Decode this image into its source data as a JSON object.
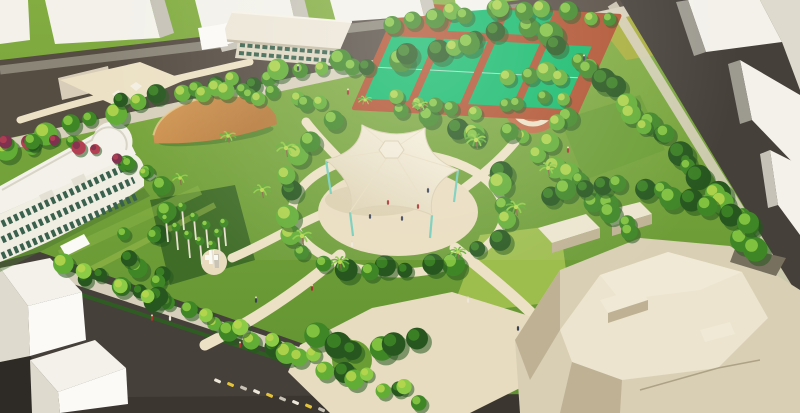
{
  "meta": {
    "title": "Aerial architectural rendering of a tropical urban park surrounded by city streets"
  },
  "palette": {
    "roadDark": "#46403a",
    "roadMid": "#554c42",
    "roadEdge": "#8a8577",
    "sidewalk": "#d7cfbb",
    "hedge": "#2f5c23",
    "path": "#ece1c4",
    "plazaCream": "#e9dcbe",
    "lawnTop": "#83ad41",
    "lawnBottom": "#5e9130",
    "lawnLight": "#9dbd4d",
    "lawnMid": "#6b9d35",
    "lawnDark": "#3f6c27",
    "lawnOlive": "#a9ae3c",
    "treeDark": "#27571f",
    "treeMid": "#3f8627",
    "treeLight": "#62ad35",
    "treeBright": "#8ccb45",
    "treeYellow": "#b9d74f",
    "flowerRed": "#b24052",
    "flowerPurple": "#7e3250",
    "bldgWhite": "#f3f1ea",
    "bldgBright": "#fbfaf6",
    "bldgFace": "#c6c2b7",
    "bldgFaceDark": "#9d9a90",
    "bldgShade": "#dedacd",
    "beigeTop": "#ece4ce",
    "beigeFace": "#d9cfb4",
    "beigeShade": "#bfb294",
    "beigeDark": "#8f8468",
    "courtGreen": "#12b96a",
    "courtRed": "#b0512f",
    "courtRedLight": "#c06a45",
    "canopyCream": "#f6f0dd",
    "canopyEdge": "#dcd0b0",
    "canopyShadow": "#cfc19e",
    "columnTeal": "#72ccba",
    "domeTan": "#d49a57",
    "domeDark": "#b6793a",
    "statueGold": "#e6bf3e",
    "trunkBrown": "#8a6b48",
    "palmWhite": "#e8e0cf",
    "windowGreen": "#3a614d",
    "shadowDark": "#2e2a26"
  },
  "scene": {
    "description": "Bird's-eye render of a park: white city blocks around the edges, dark perimeter streets, a historic white colonnaded building on the left, an activity building with a wide flat roof at top, four bright-green sport courts with terracotta surrounds, a gold statue plaza, an orange shade pavilion, a royal-palm grove, and a large cream tensile canopy over a circular central plaza; a faceted beige civic complex fills the lower right.",
    "elements": [
      {
        "name": "perimeter-roads",
        "desc": "dark asphalt streets on all four sides"
      },
      {
        "name": "city-blocks",
        "desc": "white massing models of surrounding buildings"
      },
      {
        "name": "historic-building",
        "desc": "white 3-storey building with green shuttered windows and curved corner"
      },
      {
        "name": "activity-building",
        "desc": "two-storey hall with oversized flat roof"
      },
      {
        "name": "sport-courts",
        "desc": "bright green courts with terracotta borders"
      },
      {
        "name": "statue-plaza",
        "desc": "circular plaza with golden statue"
      },
      {
        "name": "shade-pavilion",
        "desc": "long tan fabric canopy"
      },
      {
        "name": "performance-canopy",
        "desc": "six-point cream tensile roof on teal columns over round plaza"
      },
      {
        "name": "royal-palm-grove",
        "desc": "rows of tall white-trunk palms"
      },
      {
        "name": "monument-plaza",
        "desc": "small round plaza with white sculpture"
      },
      {
        "name": "civic-complex",
        "desc": "large faceted beige building mass, lower right"
      }
    ],
    "tree_belts": [
      {
        "name": "top-edge",
        "pts": [
          [
            0,
            152
          ],
          [
            140,
            98
          ],
          [
            290,
            72
          ],
          [
            430,
            52
          ],
          [
            525,
            30
          ]
        ],
        "n": 30,
        "spread": 18,
        "rmin": 7,
        "rmax": 13,
        "cols": [
          [
            "treeMid",
            "treeBright"
          ],
          [
            "treeDark",
            "treeMid"
          ],
          [
            "treeLight",
            "treeYellow"
          ]
        ]
      },
      {
        "name": "behind-courts",
        "pts": [
          [
            380,
            30
          ],
          [
            460,
            12
          ],
          [
            555,
            12
          ],
          [
            618,
            26
          ]
        ],
        "n": 12,
        "spread": 12,
        "rmin": 7,
        "rmax": 11,
        "cols": [
          [
            "treeMid",
            "treeBright"
          ],
          [
            "treeLight",
            "treeYellow"
          ]
        ]
      },
      {
        "name": "right-edge",
        "pts": [
          [
            548,
            38
          ],
          [
            610,
            86
          ],
          [
            672,
            146
          ],
          [
            735,
            212
          ],
          [
            762,
            252
          ]
        ],
        "n": 24,
        "spread": 16,
        "rmin": 8,
        "rmax": 14,
        "cols": [
          [
            "treeMid",
            "treeBright"
          ],
          [
            "treeDark",
            "treeMid"
          ],
          [
            "treeLight",
            "treeYellow"
          ]
        ]
      },
      {
        "name": "right-inner",
        "pts": [
          [
            540,
            150
          ],
          [
            588,
            190
          ],
          [
            640,
            235
          ]
        ],
        "n": 10,
        "spread": 14,
        "rmin": 8,
        "rmax": 12,
        "cols": [
          [
            "treeMid",
            "treeBright"
          ],
          [
            "treeLight",
            "treeYellow"
          ]
        ]
      },
      {
        "name": "bottom-edge",
        "pts": [
          [
            55,
            262
          ],
          [
            150,
            298
          ],
          [
            255,
            340
          ],
          [
            360,
            382
          ],
          [
            428,
            402
          ]
        ],
        "n": 20,
        "spread": 12,
        "rmin": 7,
        "rmax": 12,
        "cols": [
          [
            "treeMid",
            "treeBright"
          ],
          [
            "treeDark",
            "treeMid"
          ],
          [
            "treeLight",
            "treeYellow"
          ]
        ]
      },
      {
        "name": "plaza-ring",
        "pts": [
          [
            398,
            110
          ],
          [
            470,
            130
          ],
          [
            505,
            170
          ],
          [
            500,
            235
          ],
          [
            445,
            268
          ],
          [
            360,
            272
          ],
          [
            300,
            250
          ],
          [
            282,
            205
          ],
          [
            300,
            150
          ],
          [
            340,
            118
          ]
        ],
        "n": 26,
        "spread": 12,
        "rmin": 8,
        "rmax": 13,
        "cols": [
          [
            "treeMid",
            "treeBright"
          ],
          [
            "treeDark",
            "treeMid"
          ],
          [
            "treeLight",
            "treeYellow"
          ]
        ]
      },
      {
        "name": "interior-west",
        "pts": [
          [
            130,
            165
          ],
          [
            165,
            175
          ],
          [
            155,
            300
          ],
          [
            120,
            230
          ]
        ],
        "n": 12,
        "spread": 18,
        "rmin": 7,
        "rmax": 12,
        "cols": [
          [
            "treeMid",
            "treeBright"
          ],
          [
            "treeDark",
            "treeMid"
          ]
        ]
      },
      {
        "name": "statue-ring",
        "pts": [
          [
            502,
            78
          ],
          [
            556,
            70
          ],
          [
            572,
            112
          ],
          [
            548,
            140
          ],
          [
            504,
            128
          ]
        ],
        "n": 10,
        "spread": 8,
        "rmin": 7,
        "rmax": 11,
        "cols": [
          [
            "treeMid",
            "treeBright"
          ],
          [
            "treeLight",
            "treeYellow"
          ]
        ]
      },
      {
        "name": "complex-back",
        "pts": [
          [
            540,
            196
          ],
          [
            615,
            186
          ],
          [
            695,
            198
          ],
          [
            755,
            226
          ]
        ],
        "n": 12,
        "spread": 10,
        "rmin": 9,
        "rmax": 13,
        "cols": [
          [
            "treeMid",
            "treeBright"
          ],
          [
            "treeDark",
            "treeMid"
          ]
        ]
      },
      {
        "name": "left-shrubs",
        "pts": [
          [
            0,
            140
          ],
          [
            60,
            140
          ],
          [
            118,
            155
          ],
          [
            150,
            175
          ]
        ],
        "n": 10,
        "spread": 8,
        "rmin": 5,
        "rmax": 9,
        "cols": [
          [
            "flowerRed",
            "flowerPurple"
          ],
          [
            "treeMid",
            "treeBright"
          ],
          [
            "flowerPurple",
            "flowerRed"
          ],
          [
            "treeLight",
            "treeYellow"
          ]
        ]
      },
      {
        "name": "court-front",
        "pts": [
          [
            388,
            95
          ],
          [
            470,
            112
          ],
          [
            548,
            96
          ]
        ],
        "n": 8,
        "spread": 8,
        "rmin": 6,
        "rmax": 9,
        "cols": [
          [
            "treeMid",
            "treeBright"
          ],
          [
            "treeLight",
            "treeYellow"
          ]
        ]
      },
      {
        "name": "street-trees",
        "pts": [
          [
            56,
            262
          ],
          [
            415,
            392
          ]
        ],
        "n": 9,
        "spread": 3,
        "rmin": 7,
        "rmax": 9,
        "cols": [
          [
            "treeBright",
            "treeYellow"
          ]
        ]
      },
      {
        "name": "north-clump",
        "pts": [
          [
            200,
            90
          ],
          [
            260,
            95
          ],
          [
            320,
            100
          ]
        ],
        "n": 10,
        "spread": 12,
        "rmin": 7,
        "rmax": 11,
        "cols": [
          [
            "treeMid",
            "treeBright"
          ],
          [
            "treeLight",
            "treeYellow"
          ]
        ]
      },
      {
        "name": "south-island",
        "pts": [
          [
            300,
            326
          ],
          [
            352,
            352
          ],
          [
            428,
            334
          ]
        ],
        "n": 6,
        "spread": 10,
        "rmin": 10,
        "rmax": 15,
        "cols": [
          [
            "treeMid",
            "treeBright"
          ],
          [
            "treeDark",
            "treeMid"
          ]
        ]
      }
    ],
    "palms": [
      [
        286,
        148,
        1
      ],
      [
        262,
        190,
        0.9
      ],
      [
        302,
        236,
        1
      ],
      [
        340,
        262,
        0.9
      ],
      [
        476,
        140,
        1
      ],
      [
        516,
        207,
        1
      ],
      [
        548,
        168,
        0.9
      ],
      [
        458,
        252,
        0.8
      ],
      [
        228,
        136,
        0.8
      ],
      [
        180,
        178,
        0.8
      ],
      [
        420,
        105,
        0.8
      ],
      [
        365,
        100,
        0.7
      ]
    ],
    "royal_palms": [
      [
        168,
        242
      ],
      [
        178,
        250
      ],
      [
        190,
        258
      ],
      [
        202,
        264
      ],
      [
        214,
        268
      ],
      [
        196,
        240
      ],
      [
        208,
        248
      ],
      [
        220,
        256
      ],
      [
        184,
        230
      ],
      [
        226,
        246
      ]
    ],
    "figures": {
      "people_colors": [
        "#a83432",
        "#3a4256",
        "#ece7da"
      ],
      "people": [
        [
          388,
          202,
          0
        ],
        [
          402,
          218,
          1
        ],
        [
          370,
          216,
          1
        ],
        [
          418,
          206,
          0
        ],
        [
          352,
          244,
          2
        ],
        [
          428,
          190,
          1
        ],
        [
          312,
          288,
          0
        ],
        [
          256,
          300,
          1
        ],
        [
          152,
          318,
          0
        ],
        [
          518,
          328,
          1
        ],
        [
          468,
          300,
          2
        ],
        [
          584,
          58,
          1
        ],
        [
          348,
          92,
          0
        ],
        [
          298,
          68,
          1
        ],
        [
          568,
          150,
          0
        ],
        [
          170,
          318,
          2
        ],
        [
          240,
          345,
          0
        ]
      ],
      "scooters": {
        "start": [
          215,
          378
        ],
        "dx": 13,
        "dy": 3.6,
        "n": 9,
        "colors": [
          "#ece7d9",
          "#e3c23c",
          "#c8c3b6"
        ]
      }
    }
  }
}
